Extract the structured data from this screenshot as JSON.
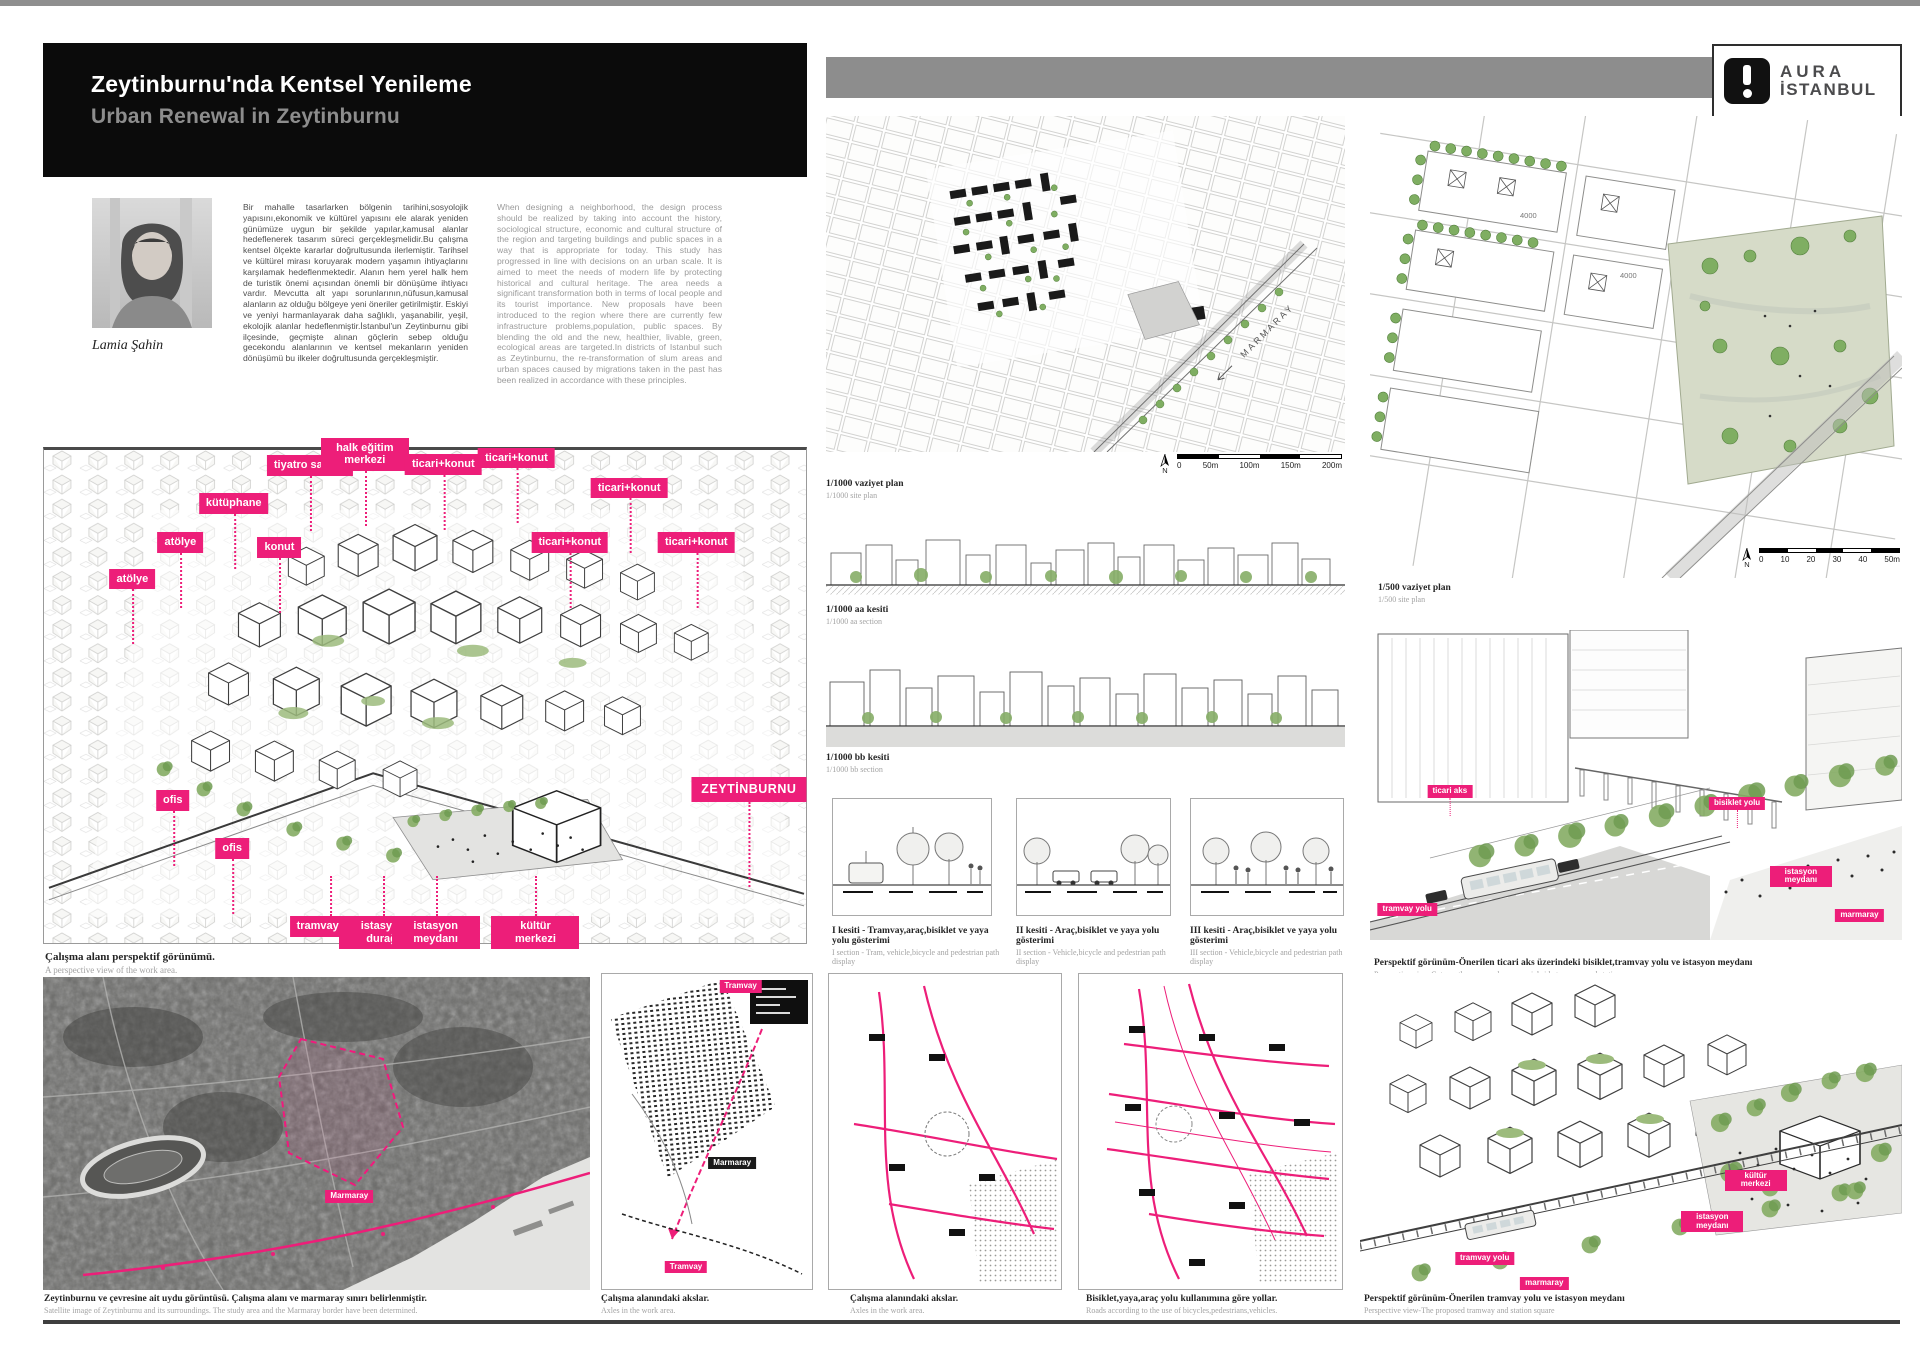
{
  "colors": {
    "pink": "#ed1e79",
    "bar_gray": "#8d8d8d",
    "tree_green": "#7fae62",
    "black": "#0b0b0b"
  },
  "header": {
    "title_tr": "Zeytinburnu'nda Kentsel Yenileme",
    "title_en": "Urban Renewal in Zeytinburnu"
  },
  "logo": {
    "brand_top": "AURA",
    "brand_bottom": "İSTANBUL"
  },
  "intro": {
    "author": "Lamia Şahin",
    "paragraph_tr": "Bir mahalle tasarlarken bölgenin tarihini,sosyolojik yapısını,ekonomik ve kültürel yapısını ele alarak yeniden günümüze uygun bir şekilde yapılar,kamusal alanlar hedeflenerek tasarım süreci gerçekleşmelidir.Bu çalışma kentsel ölçekte kararlar doğrultusunda ilerlemiştir. Tarihsel ve kültürel mirası koruyarak modern yaşamın ihtiyaçlarını karşılamak hedeflenmektedir. Alanın hem yerel halk hem de turistik önemi açısından önemli bir dönüşüme ihtiyacı vardır. Mevcutta alt yapı sorunlarının,nüfusun,kamusal alanların az olduğu bölgeye yeni öneriler getirilmiştir. Eskiyi ve yeniyi harmanlayarak daha sağlıklı, yaşanabilir, yeşil, ekolojik alanlar hedeflenmiştir.İstanbul'un Zeytinburnu gibi ilçesinde, geçmişte alınan göçlerin sebep olduğu gecekondu alanlarının ve kentsel mekanların yeniden dönüşümü bu ilkeler doğrultusunda gerçekleşmiştir.",
    "paragraph_en": "When designing a neighborhood, the design process should be realized by taking into account the history, sociological structure, economic and cultural structure of the region and targeting buildings and public spaces in a way that is appropriate for today. This study has progressed in line with decisions on an urban scale. It is aimed to meet the needs of modern life by protecting historical and cultural heritage. The area needs a significant transformation both in terms of local people and its tourist importance. New proposals have been introduced to the region where there are currently few infrastructure problems,population, public spaces. By blending the old and the new, healthier, livable, green, ecological areas are targeted.In districts of Istanbul such as Zeytinburnu, the re-transformation of slum areas and urban spaces caused by migrations taken in the past has been realized in accordance with these principles."
  },
  "axon": {
    "caption_tr": "Çalışma alanı perspektif görünümü.",
    "caption_en": "A perspective view of the work area.",
    "labels": [
      {
        "text": "atölye",
        "x": 11.6,
        "y": 24.1,
        "dir": "down"
      },
      {
        "text": "atölye",
        "x": 17.9,
        "y": 16.7,
        "dir": "down"
      },
      {
        "text": "kütüphane",
        "x": 24.9,
        "y": 8.7,
        "dir": "down"
      },
      {
        "text": "konut",
        "x": 30.9,
        "y": 17.7,
        "dir": "down"
      },
      {
        "text": "tiyatro salonu",
        "x": 34.9,
        "y": 1.0,
        "dir": "down"
      },
      {
        "text": "halk eğitim merkezi",
        "x": 42.1,
        "y": -2.5,
        "dir": "down"
      },
      {
        "text": "ticari+konut",
        "x": 52.4,
        "y": 0.8,
        "dir": "down"
      },
      {
        "text": "ticari+konut",
        "x": 62.0,
        "y": -0.5,
        "dir": "down"
      },
      {
        "text": "ticari+konut",
        "x": 76.8,
        "y": 5.6,
        "dir": "down"
      },
      {
        "text": "ticari+konut",
        "x": 69.0,
        "y": 16.7,
        "dir": "down"
      },
      {
        "text": "ticari+konut",
        "x": 85.6,
        "y": 16.7,
        "dir": "down"
      },
      {
        "text": "ofis",
        "x": 16.9,
        "y": 69.0,
        "dir": "down"
      },
      {
        "text": "ofis",
        "x": 24.7,
        "y": 78.7,
        "dir": "down"
      },
      {
        "text": "ZEYTİNBURNU",
        "x": 92.5,
        "y": 66.4,
        "dir": "down",
        "cls": "lg"
      },
      {
        "text": "tramvay yolu",
        "x": 37.6,
        "y": 94.5,
        "dir": "up"
      },
      {
        "text": "istasyon durağı",
        "x": 44.5,
        "y": 94.5,
        "dir": "up"
      },
      {
        "text": "istasyon meydanı",
        "x": 51.4,
        "y": 94.5,
        "dir": "up"
      },
      {
        "text": "kültür merkezi",
        "x": 64.5,
        "y": 94.5,
        "dir": "up"
      }
    ]
  },
  "plan1000": {
    "caption_tr": "1/1000 vaziyet plan",
    "caption_en": "1/1000 site plan",
    "road_label": "MARMARAY",
    "north": "N",
    "scale_ticks": [
      "0",
      "50m",
      "100m",
      "150m",
      "200m"
    ]
  },
  "section_aa": {
    "caption_tr": "1/1000 aa kesiti",
    "caption_en": "1/1000 aa section"
  },
  "section_bb": {
    "caption_tr": "1/1000 bb kesiti",
    "caption_en": "1/1000 bb section"
  },
  "cross_sections": [
    {
      "tr": "I kesiti - Tramvay,araç,bisiklet ve yaya yolu gösterimi",
      "en": "I section - Tram, vehicle,bicycle and pedestrian path display"
    },
    {
      "tr": "II kesiti - Araç,bisiklet ve yaya yolu gösterimi",
      "en": "II section - Vehicle,bicycle and pedestrian path display"
    },
    {
      "tr": "III kesiti - Araç,bisiklet ve yaya yolu gösterimi",
      "en": "III section - Vehicle,bicycle and pedestrian path display"
    }
  ],
  "plan500": {
    "caption_tr": "1/500 vaziyet plan",
    "caption_en": "1/500 site plan",
    "north": "N",
    "scale_ticks": [
      "0",
      "10",
      "20",
      "30",
      "40",
      "50m"
    ],
    "lot_labels": [
      "4000",
      "4000"
    ]
  },
  "persp_axis": {
    "caption_tr": "Perspektif görünüm-Önerilen ticari aks üzerindeki bisiklet,tramvay yolu ve istasyon meydanı",
    "caption_en": "Perspective view-Gate on the proposed commercial side tramway and station square",
    "labels": [
      {
        "text": "ticari aks",
        "x": 15,
        "y": 50,
        "cls": "sm",
        "dir": "down"
      },
      {
        "text": "bisiklet yolu",
        "x": 69,
        "y": 54,
        "cls": "sm",
        "dir": "down"
      },
      {
        "text": "istasyon meydanı",
        "x": 81,
        "y": 76,
        "cls": "sm"
      },
      {
        "text": "tramvay yolu",
        "x": 7,
        "y": 88,
        "cls": "sm"
      },
      {
        "text": "marmaray",
        "x": 92,
        "y": 90,
        "cls": "sm"
      }
    ]
  },
  "satellite": {
    "caption_tr": "Zeytinburnu ve çevresine ait uydu görüntüsü. Çalışma alanı ve marmaray sınırı belirlenmiştir.",
    "caption_en": "Satellite image of Zeytinburnu and its surroundings. The study area and the Marmaray border have been determined.",
    "labels": [
      {
        "text": "Marmaray",
        "x": 56,
        "y": 68,
        "cls": "sm"
      }
    ]
  },
  "axes_map": {
    "caption_tr": "Çalışma alanındaki akslar.",
    "caption_en": "Axles in the work area.",
    "labels": [
      {
        "text": "Tramvay",
        "x": 66,
        "y": 2,
        "cls": "sm"
      },
      {
        "text": "Marmaray",
        "x": 62,
        "y": 58,
        "cls": "sm dark"
      },
      {
        "text": "Tramvay",
        "x": 40,
        "y": 91,
        "cls": "sm"
      }
    ]
  },
  "axes_diagram": {
    "caption_tr": "Çalışma alanındaki akslar.",
    "caption_en": "Axles in the work area."
  },
  "roads_diagram": {
    "caption_tr": "Bisiklet,yaya,araç yolu kullanımına göre yollar.",
    "caption_en": "Roads according to the use of bicycles,pedestrians,vehicles."
  },
  "persp_tram": {
    "caption_tr": "Perspektif görünüm-Önerilen tramvay yolu ve istasyon meydanı",
    "caption_en": "Perspective view-The proposed tramway and station square",
    "labels": [
      {
        "text": "kültür merkezi",
        "x": 73,
        "y": 62,
        "cls": "sm"
      },
      {
        "text": "istasyon meydanı",
        "x": 65,
        "y": 75,
        "cls": "sm"
      },
      {
        "text": "tramvay yolu",
        "x": 23,
        "y": 88,
        "cls": "sm"
      },
      {
        "text": "marmaray",
        "x": 34,
        "y": 96,
        "cls": "sm"
      }
    ]
  }
}
